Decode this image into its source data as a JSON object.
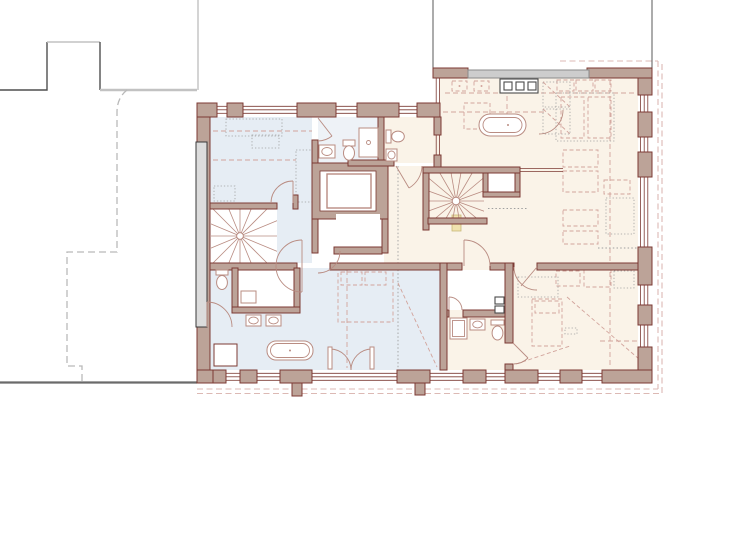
{
  "meta": {
    "type": "architectural-floor-plan",
    "visible_text": []
  },
  "palette": {
    "wall_fill": "#bca398",
    "wall_stroke": "#7c3a33",
    "fixture": "#b98c82",
    "dashed_pink": "#d2a49c",
    "dotted_gray": "#9f9f9f",
    "room_blue": "#e6edf4",
    "room_cream": "#faf3e8",
    "skylight_gray": "#cdcdcd",
    "skylight_stroke": "#8a8a8a",
    "neighbor_dark": "#4f4f4f",
    "neighbor_light": "#c2c2c2",
    "neighbor_strip": "#dcdcdc",
    "boundary_dash": "#dcb9b4",
    "accent_yellow": "#f0e2ae",
    "accent_yellow_stroke": "#c9b878",
    "ground": "#6a6a6a"
  },
  "plan": {
    "rooms": [
      {
        "name": "bedroom-top-left",
        "tint": "blue"
      },
      {
        "name": "bathroom-top-center",
        "tint": "blue"
      },
      {
        "name": "wc-top-center",
        "tint": "cream"
      },
      {
        "name": "hall-landing",
        "tint": "cream"
      },
      {
        "name": "suite-top-right",
        "tint": "cream"
      },
      {
        "name": "bedroom-bottom-right",
        "tint": "cream"
      },
      {
        "name": "bathroom-bottom-middle",
        "tint": "cream"
      },
      {
        "name": "walk-in-closet",
        "tint": "white"
      },
      {
        "name": "bedroom-bottom-left",
        "tint": "blue"
      },
      {
        "name": "shower-room-bottom-left",
        "tint": "white"
      },
      {
        "name": "wc-bottom-left",
        "tint": "blue"
      },
      {
        "name": "corridor-left",
        "tint": "blue"
      },
      {
        "name": "elevator-lobby",
        "tint": "white"
      }
    ],
    "circulation": [
      {
        "name": "main-stair",
        "style": "winder-fan"
      },
      {
        "name": "spiral-stair",
        "style": "winder-fan"
      },
      {
        "name": "elevator",
        "style": "shaft-with-cab"
      }
    ],
    "fixtures": [
      "freestanding-bathtub",
      "built-in-bathtub",
      "toilet-x4",
      "washbasin-x6",
      "shower-cabin",
      "vanity-cabinet",
      "kitchen-appliance-squares-x3",
      "closet-cabinet"
    ],
    "context": [
      "neighbor-building-outline",
      "property-line-dash-dot",
      "roof-overhang-dashed-boundary",
      "skylight-strip",
      "party-wall-strip",
      "ground-line"
    ]
  }
}
